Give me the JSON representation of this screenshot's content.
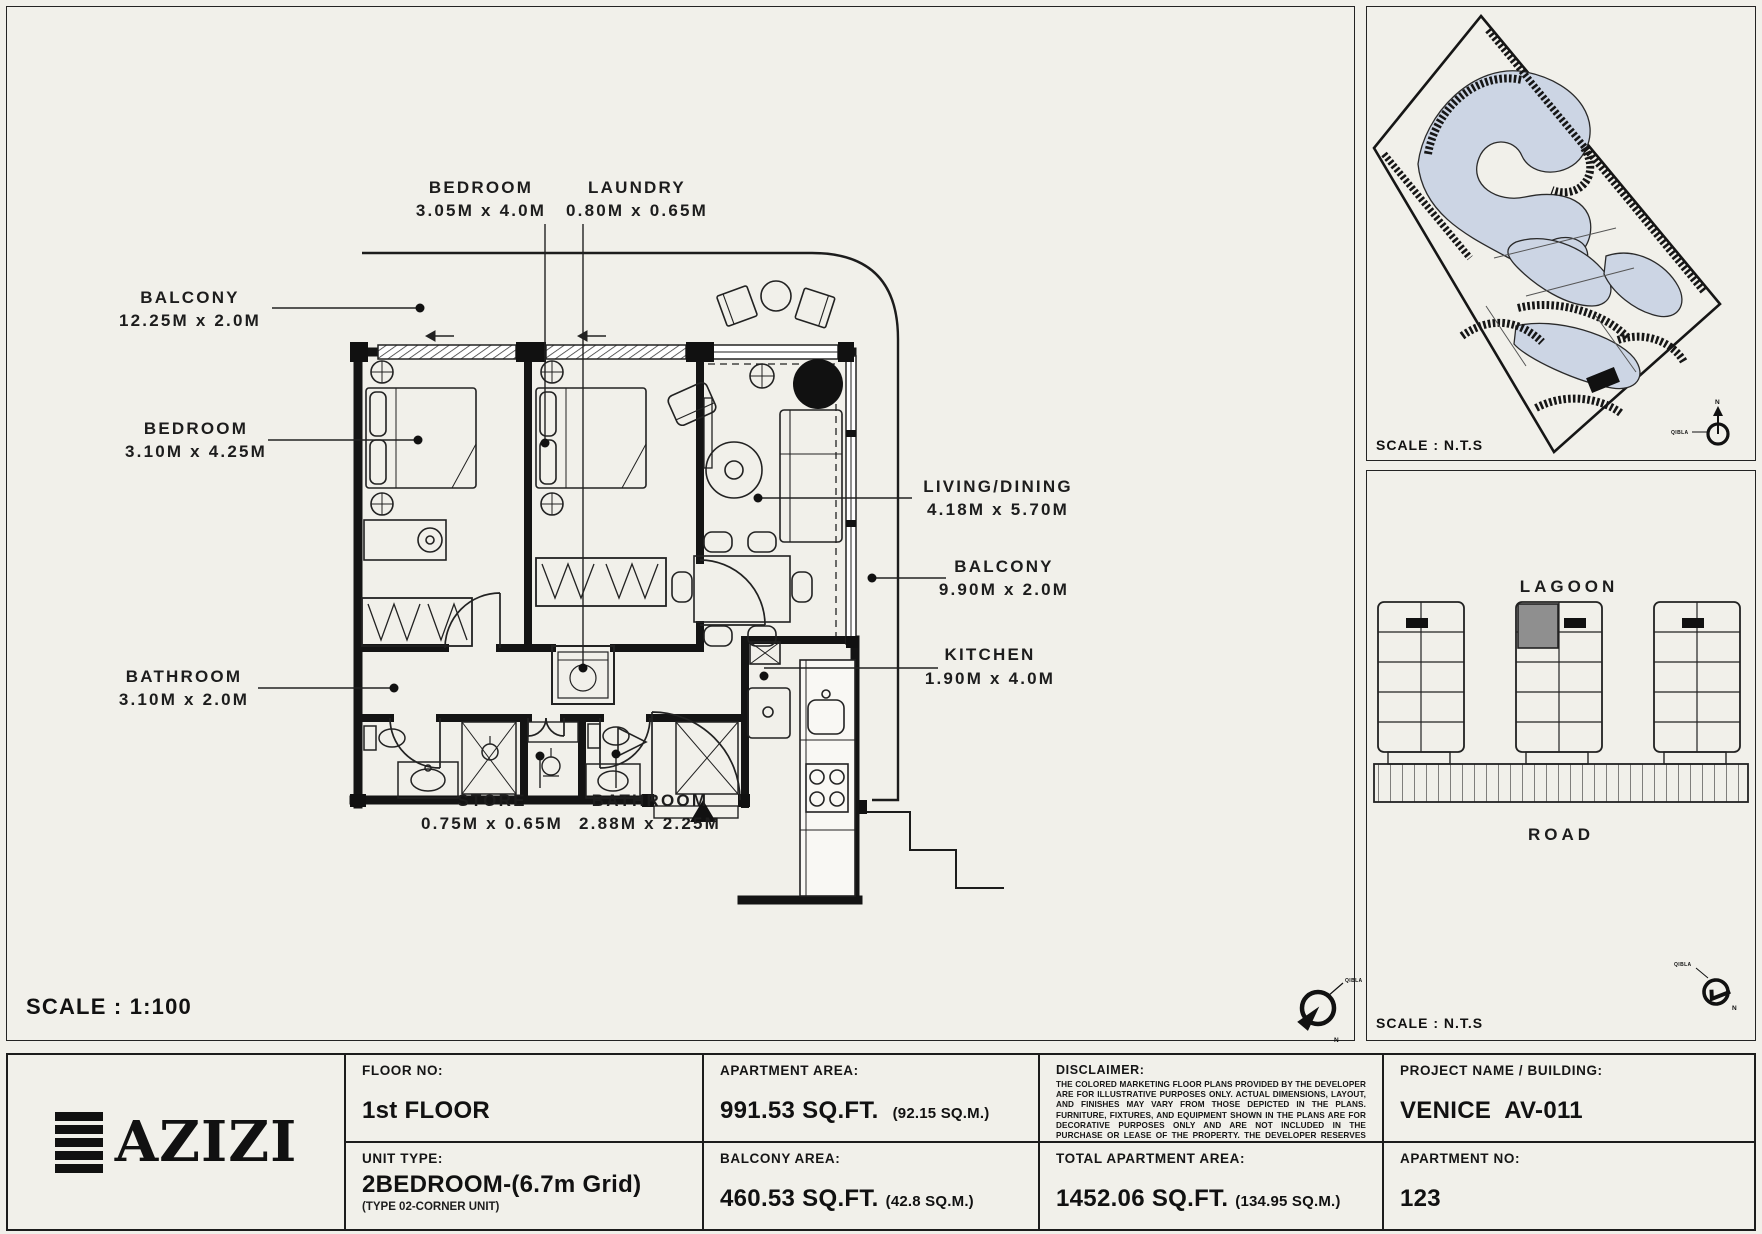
{
  "colors": {
    "bg": "#f1f0ea",
    "line": "#1c1c1c",
    "lagoon": "#ccd5e4",
    "highlight": "#8f8f8f"
  },
  "plan": {
    "scale": "SCALE : 1:100",
    "compass": {
      "north": "N",
      "qibla": "QIBLA"
    },
    "rooms": {
      "bedroom_top": {
        "name": "BEDROOM",
        "dims": "3.05M x 4.0M"
      },
      "laundry": {
        "name": "LAUNDRY",
        "dims": "0.80M x 0.65M"
      },
      "balcony_left": {
        "name": "BALCONY",
        "dims": "12.25M x 2.0M"
      },
      "bedroom_left": {
        "name": "BEDROOM",
        "dims": "3.10M x 4.25M"
      },
      "bathroom_left": {
        "name": "BATHROOM",
        "dims": "3.10M x 2.0M"
      },
      "living": {
        "name": "LIVING/DINING",
        "dims": "4.18M x 5.70M"
      },
      "balcony_right": {
        "name": "BALCONY",
        "dims": "9.90M x 2.0M"
      },
      "kitchen": {
        "name": "KITCHEN",
        "dims": "1.90M x 4.0M"
      },
      "store": {
        "name": "STORE",
        "dims": "0.75M x 0.65M"
      },
      "bathroom_bottom": {
        "name": "BATHROOM",
        "dims": "2.88M x 2.25M"
      }
    }
  },
  "site_map": {
    "scale": "SCALE : N.T.S",
    "compass": {
      "north": "N",
      "qibla": "QIBLA"
    }
  },
  "key_plan": {
    "lagoon": "LAGOON",
    "road": "ROAD",
    "scale": "SCALE : N.T.S",
    "compass": {
      "north": "N",
      "qibla": "QIBLA"
    }
  },
  "footer": {
    "brand": "AZIZI",
    "floor": {
      "label": "FLOOR NO:",
      "value": "1st FLOOR"
    },
    "unit_type": {
      "label": "UNIT TYPE:",
      "value": "2BEDROOM-(6.7m Grid)",
      "note": "(TYPE 02-CORNER UNIT)"
    },
    "apartment_area": {
      "label": "APARTMENT AREA:",
      "value": "991.53 SQ.FT.",
      "metric": "(92.15 SQ.M.)"
    },
    "balcony_area": {
      "label": "BALCONY AREA:",
      "value": "460.53 SQ.FT.",
      "metric": "(42.8 SQ.M.)"
    },
    "disclaimer": {
      "label": "DISCLAIMER:",
      "body": "THE COLORED MARKETING FLOOR PLANS PROVIDED BY THE DEVELOPER ARE FOR ILLUSTRATIVE PURPOSES ONLY. ACTUAL DIMENSIONS, LAYOUT, AND FINISHES MAY VARY FROM THOSE DEPICTED IN THE PLANS. FURNITURE, FIXTURES, AND EQUIPMENT SHOWN IN THE PLANS ARE FOR DECORATIVE PURPOSES ONLY AND ARE NOT INCLUDED IN THE PURCHASE OR LEASE OF THE PROPERTY. THE DEVELOPER RESERVES THE RIGHT TO MAKE MODIFICATIONS, REVISIONS, AND CHANGES TO THE FLOOR PLANS, SPECIFICATIONS, AND FEATURES WITHOUT PRIOR NOTICE."
    },
    "total_area": {
      "label": "TOTAL APARTMENT AREA:",
      "value": "1452.06 SQ.FT.",
      "metric": "(134.95 SQ.M.)"
    },
    "project": {
      "label": "PROJECT NAME / BUILDING:",
      "value": "VENICE  AV-011"
    },
    "apartment_no": {
      "label": "APARTMENT NO:",
      "value": "123"
    }
  }
}
